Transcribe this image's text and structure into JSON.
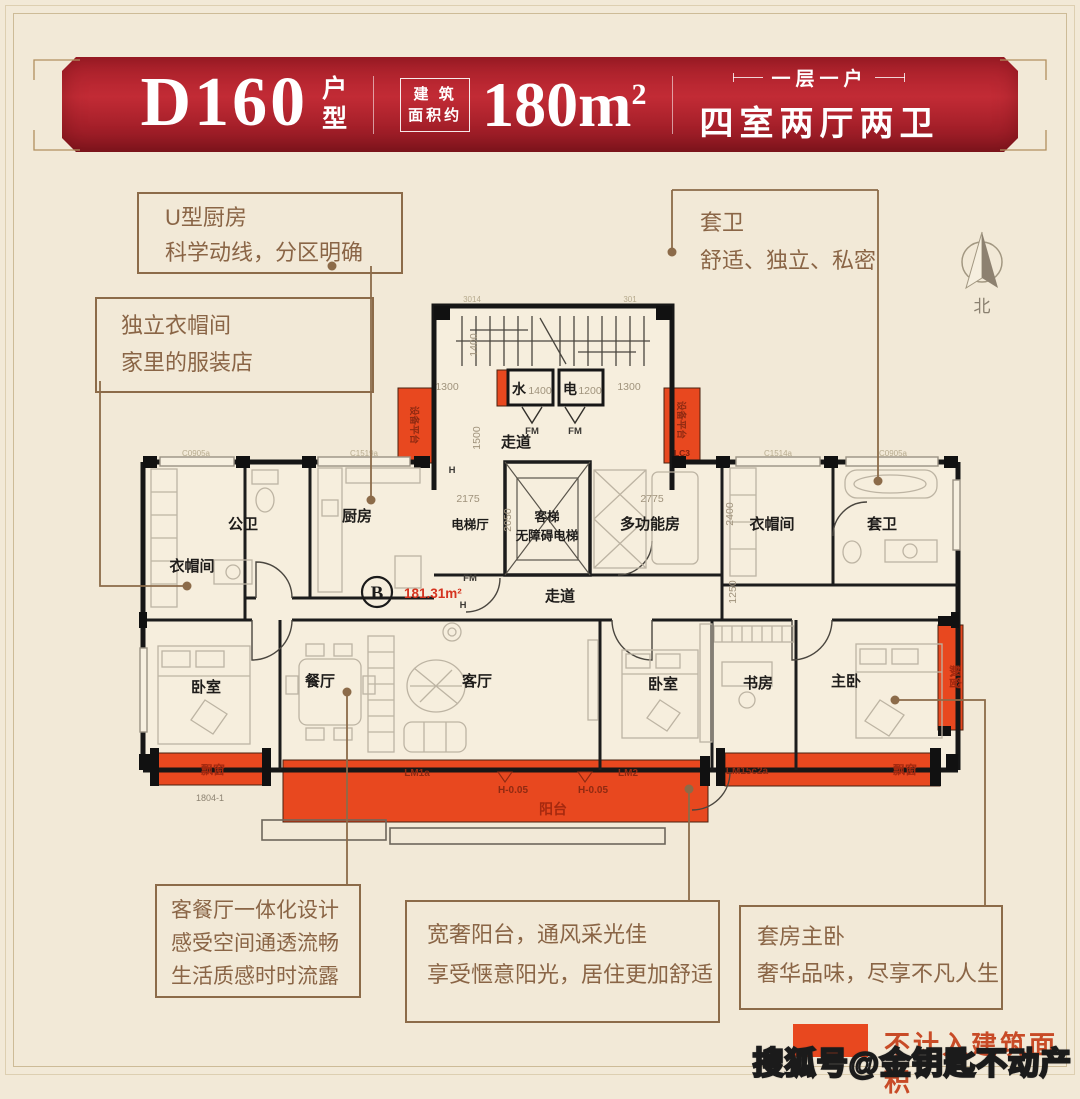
{
  "header": {
    "model": "D160",
    "model_suffix_1": "户",
    "model_suffix_2": "型",
    "area_label_1": "建 筑",
    "area_label_2": "面积约",
    "area_value": "180m",
    "area_sup": "2",
    "subtitle_top": "一层一户",
    "subtitle_main": "四室两厅两卫"
  },
  "callouts": {
    "kitchen": {
      "l1": "U型厨房",
      "l2": "科学动线，分区明确"
    },
    "cloakroom": {
      "l1": "独立衣帽间",
      "l2": "家里的服装店"
    },
    "suite_bath": {
      "l1": "套卫",
      "l2": "舒适、独立、私密"
    },
    "living": {
      "l1": "客餐厅一体化设计",
      "l2": "感受空间通透流畅",
      "l3": "生活质感时时流露"
    },
    "balcony": {
      "l1": "宽奢阳台，通风采光佳",
      "l2": "享受惬意阳光，居住更加舒适"
    },
    "master": {
      "l1": "套房主卧",
      "l2": "奢华品味，尽享不凡人生"
    }
  },
  "compass": {
    "label": "北"
  },
  "legend": {
    "label": "不计入建筑面积",
    "color": "#e8481f"
  },
  "watermark": "搜狐号@金钥匙不动产",
  "floorplan": {
    "unit_mark": "B",
    "area_label": "181.31m²",
    "rooms": {
      "cloakroom_left": "衣帽间",
      "public_bath": "公卫",
      "kitchen": "厨房",
      "elevator_hall": "电梯厅",
      "elevator_line1": "客梯",
      "elevator_line2": "无障碍电梯",
      "multifunction": "多功能房",
      "cloakroom_right": "衣帽间",
      "suite_bath": "套卫",
      "corridor_core": "走道",
      "corridor_main": "走道",
      "bedroom_left": "卧室",
      "dining": "餐厅",
      "living": "客厅",
      "bedroom_mid": "卧室",
      "study": "书房",
      "master": "主卧",
      "balcony": "阳台",
      "bay_left": "飘窗",
      "bay_right": "飘窗",
      "bay_side": "飘窗",
      "equipment_left": "设备平台",
      "equipment_right": "设备平台",
      "water": "水",
      "electric": "电"
    },
    "dims": {
      "d1400": "1400",
      "d1500": "1500",
      "d1300": "1300",
      "d2175": "2175",
      "d2775": "2775",
      "d2400": "2400",
      "d1250": "1250",
      "d2050": "2050",
      "w1400": "1400",
      "e1200": "1200"
    },
    "marks": {
      "fm": "FM",
      "h": "H",
      "lc3": "LC3",
      "lm1a": "LM1a",
      "lm2": "LM2",
      "lm15": "LM15c2a",
      "hlevel": "H-0.05",
      "code_top1": "3014",
      "code_top2": "301",
      "code_bay": "1804-1",
      "win1": "C0905a",
      "win2": "C1519a",
      "win3": "C1514a"
    }
  }
}
